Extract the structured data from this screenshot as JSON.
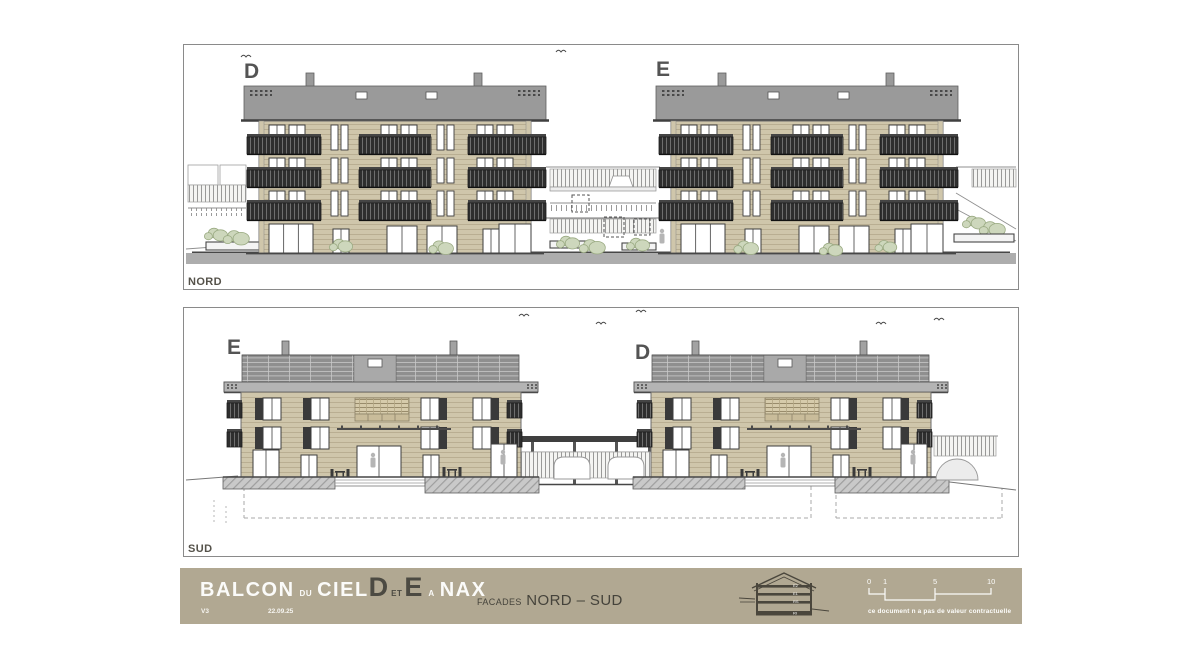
{
  "panels": {
    "nord": {
      "label": "NORD",
      "buildings": [
        {
          "label": "D"
        },
        {
          "label": "E"
        }
      ]
    },
    "sud": {
      "label": "SUD",
      "buildings": [
        {
          "label": "E"
        },
        {
          "label": "D"
        }
      ]
    }
  },
  "titlebar": {
    "project": {
      "w1": "BALCON",
      "w2": "DU",
      "w3": "CIEL",
      "b1": "D",
      "w4": "ET",
      "b2": "E",
      "w5": "A",
      "w6": "NAX"
    },
    "version": "V3",
    "date": "22.09.25",
    "subtitle_small": "FACADES",
    "subtitle_big": "NORD – SUD",
    "section_icon_levels": [
      "E2",
      "E1",
      "RS",
      "RI"
    ],
    "scale": {
      "ticks": [
        "0",
        "1",
        "5",
        "10"
      ]
    },
    "disclaimer": "ce document n a pas de valeur contractuelle"
  },
  "colors": {
    "titlebar_bg": "#b1a892",
    "panel_border": "#8a8a8a",
    "roof": "#9a9a9a",
    "roof_edge": "#3f3f3f",
    "facade": "#cfc6ab",
    "facade_stripe": "#b9ae92",
    "window_frame": "#3e3e3e",
    "glass": "#ffffff",
    "balcony_dark": "#2e2e2e",
    "balcony_slat": "#6e6e6e",
    "balcony_rail": "#454545",
    "solar": "#8f8f8f",
    "solar_line": "#c8c8c8",
    "fascia": "#b4b4b4",
    "ground_band": "#adadad",
    "wall_gray": "#c9c9c9",
    "bush_fill": "#cdd7bc",
    "bush_stroke": "#9aaa82",
    "line_dark": "#474747",
    "sketch": "#8f8f8f",
    "trellis_bg": "#d6cbab",
    "trellis_line": "#998c6c",
    "icon_dark": "#4a463c"
  }
}
